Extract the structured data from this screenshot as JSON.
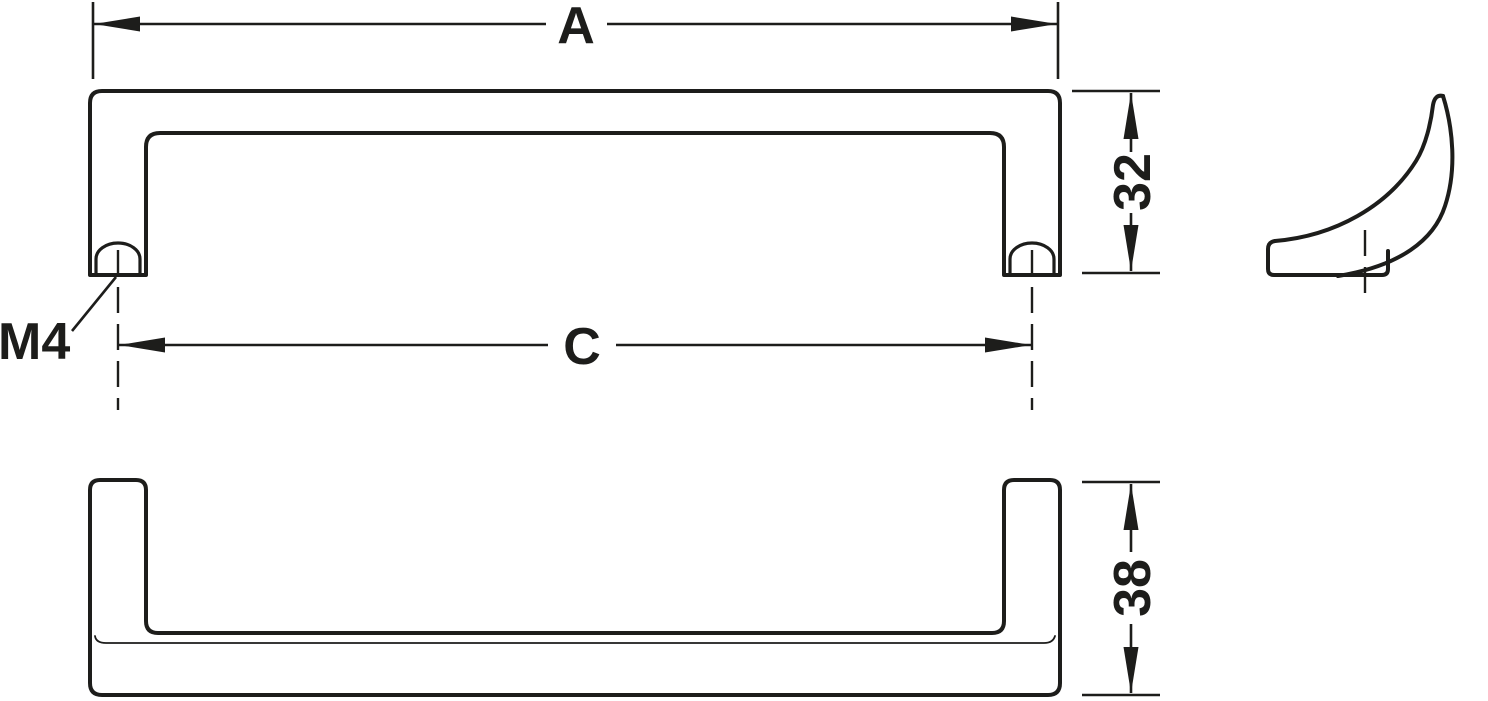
{
  "labels": {
    "overall_width": "A",
    "hole_spacing": "C",
    "height": "32",
    "projection_depth": "38",
    "thread": "M4"
  },
  "colors": {
    "ink": "#1d1d1b",
    "background": "#ffffff"
  }
}
